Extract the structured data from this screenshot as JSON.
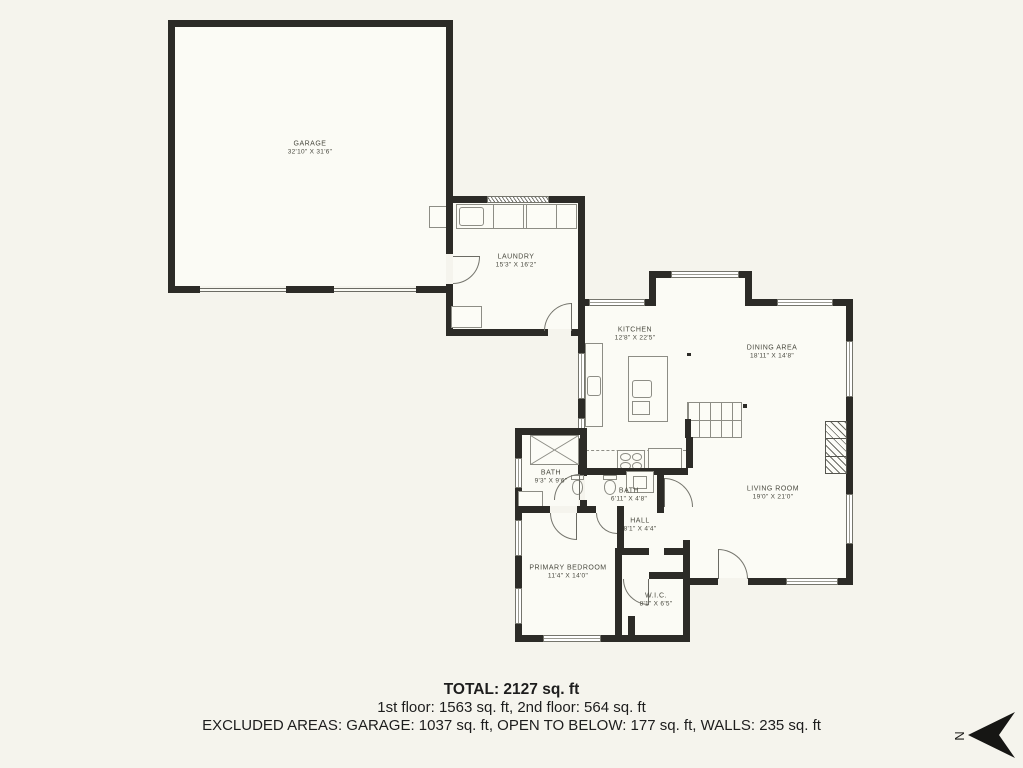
{
  "plan": {
    "rooms": {
      "garage": {
        "name": "GARAGE",
        "dims": "32'10\" X 31'6\""
      },
      "laundry": {
        "name": "LAUNDRY",
        "dims": "15'3\" X 16'2\""
      },
      "kitchen": {
        "name": "KITCHEN",
        "dims": "12'8\" X 22'5\""
      },
      "dining": {
        "name": "DINING AREA",
        "dims": "18'11\" X 14'8\""
      },
      "living": {
        "name": "LIVING ROOM",
        "dims": "19'0\" X 21'0\""
      },
      "bath1": {
        "name": "BATH",
        "dims": "9'3\" X 9'6\""
      },
      "bath2": {
        "name": "BATH",
        "dims": "6'11\" X 4'8\""
      },
      "hall": {
        "name": "HALL",
        "dims": "8'1\" X 4'4\""
      },
      "primary_bedroom": {
        "name": "PRIMARY BEDROOM",
        "dims": "11'4\" X 14'0\""
      },
      "wic": {
        "name": "W.I.C.",
        "dims": "8'1\" X 6'5\""
      }
    },
    "summary": {
      "total": "TOTAL: 2127 sq. ft",
      "floors": "1st floor: 1563 sq. ft, 2nd floor: 564 sq. ft",
      "excluded": "EXCLUDED AREAS: GARAGE: 1037 sq. ft, OPEN TO BELOW: 177 sq. ft, WALLS: 235 sq. ft"
    },
    "compass": {
      "letter": "N"
    },
    "colors": {
      "wall": "#2c2b27",
      "background": "#f5f4ed",
      "line": "#8d8d85"
    }
  }
}
